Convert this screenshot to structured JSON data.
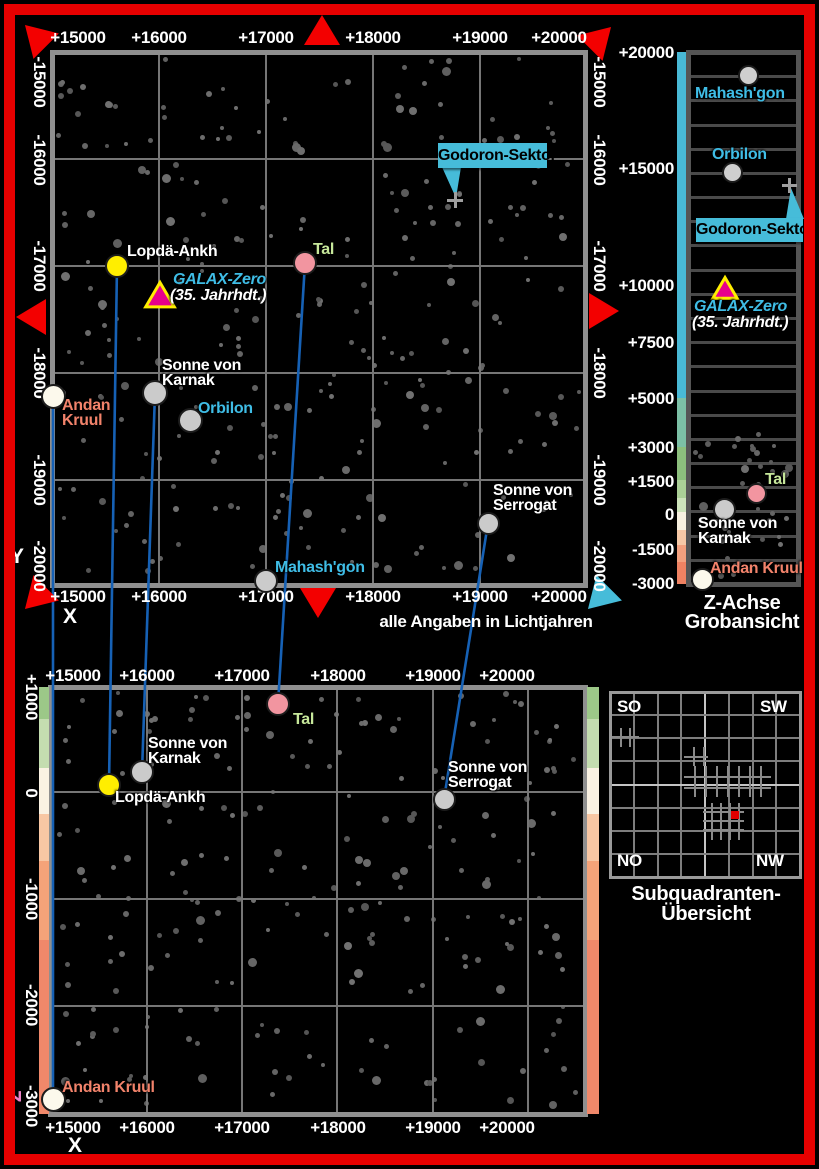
{
  "annotation": "alle Angaben in Lichtjahren",
  "axis_letters": {
    "y": "Y",
    "x_top": "X",
    "x_bottom": "X",
    "z": "Z"
  },
  "colors": {
    "background": "#000000",
    "frame_red": "#e60000",
    "grid": "#767676",
    "map_border": "#8f8f8f",
    "line_blue": "#1661b5",
    "callout_bg": "#46bcd9",
    "cyan_label": "#3fbde6",
    "green_label": "#c6e79a",
    "salmon_label": "#f2836b",
    "z_letter_pink": "#ee82c8",
    "triangle_red": "#f30000",
    "galax_fill": "#e8008c",
    "galax_stroke": "#ffee00",
    "red_square": "#e10000"
  },
  "top_map": {
    "frame": {
      "x": 52,
      "y": 52,
      "w": 533,
      "h": 533
    },
    "grid_v": [
      159,
      266,
      373,
      480
    ],
    "grid_h": [
      159,
      266,
      373,
      480
    ],
    "x_ticks": {
      "labels": [
        "+15000",
        "+16000",
        "+17000",
        "+18000",
        "+19000",
        "+20000"
      ],
      "px": [
        78,
        159,
        266,
        373,
        480,
        559
      ],
      "rows": [
        38,
        597
      ]
    },
    "y_ticks": {
      "labels": [
        "-15000",
        "-16000",
        "-17000",
        "-18000",
        "-19000",
        "-20000"
      ],
      "py": [
        82,
        160,
        266,
        373,
        480,
        566
      ],
      "cols": [
        39,
        599
      ]
    },
    "starfield": {
      "seed": 11,
      "count": 265,
      "area": [
        56,
        56,
        526,
        526
      ]
    },
    "markers": [
      {
        "name": "lopda-ankh",
        "shape": "circle",
        "x": 117,
        "y": 266,
        "d": 20,
        "fill": "#ffee00"
      },
      {
        "name": "tal",
        "shape": "circle",
        "x": 305,
        "y": 263,
        "d": 20,
        "fill": "#f295a0"
      },
      {
        "name": "galax-zero",
        "shape": "triangle",
        "x": 160,
        "y": 296,
        "d": 26,
        "fill": "#e8008c"
      },
      {
        "name": "sonne-von-karnak",
        "shape": "circle",
        "x": 155,
        "y": 393,
        "d": 22,
        "fill": "#cbcbcb"
      },
      {
        "name": "orbilon",
        "shape": "circle",
        "x": 190,
        "y": 420,
        "d": 21,
        "fill": "#cbcbcb"
      },
      {
        "name": "andan-kruul",
        "shape": "circle",
        "x": 53,
        "y": 396,
        "d": 21,
        "fill": "#fcf9ec"
      },
      {
        "name": "mahashgon",
        "shape": "circle",
        "x": 266,
        "y": 581,
        "d": 20,
        "fill": "#cbcbcb"
      },
      {
        "name": "sonne-von-serrogat",
        "shape": "circle",
        "x": 488,
        "y": 523,
        "d": 19,
        "fill": "#cbcbcb"
      },
      {
        "name": "godoron-cross",
        "shape": "cross",
        "x": 455,
        "y": 200,
        "d": 16
      }
    ],
    "labels": [
      {
        "name": "lopda-ankh",
        "lines": [
          "Lopdä-Ankh"
        ],
        "x": 127,
        "y": 244,
        "color": "#ffffff"
      },
      {
        "name": "tal",
        "lines": [
          "Tal"
        ],
        "x": 313,
        "y": 242,
        "color": "#c6e79a"
      },
      {
        "name": "galax-zero",
        "lines": [
          "GALAX-Zero"
        ],
        "x": 173,
        "y": 272,
        "color": "#3fbde6",
        "italic": true
      },
      {
        "name": "galax-zero-era",
        "lines": [
          "(35. Jahrhdt.)"
        ],
        "x": 170,
        "y": 288,
        "color": "#ffffff",
        "italic": true
      },
      {
        "name": "sonne-von-karnak",
        "lines": [
          "Sonne von",
          "Karnak"
        ],
        "x": 162,
        "y": 358,
        "color": "#ffffff"
      },
      {
        "name": "orbilon",
        "lines": [
          "Orbilon"
        ],
        "x": 198,
        "y": 401,
        "color": "#3fbde6"
      },
      {
        "name": "andan-kruul",
        "lines": [
          "Andan",
          "Kruul"
        ],
        "x": 62,
        "y": 398,
        "color": "#f2836b"
      },
      {
        "name": "mahashgon",
        "lines": [
          "Mahash'gon"
        ],
        "x": 275,
        "y": 560,
        "color": "#3fbde6"
      },
      {
        "name": "sonne-von-serrogat",
        "lines": [
          "Sonne von",
          "Serrogat"
        ],
        "x": 493,
        "y": 483,
        "color": "#ffffff"
      }
    ],
    "callout": {
      "text": "Godoron-Sektor",
      "x": 438,
      "y": 143,
      "w": 109,
      "h": 25,
      "tail": [
        [
          442,
          167
        ],
        [
          461,
          167
        ],
        [
          456,
          198
        ]
      ]
    }
  },
  "bottom_map": {
    "frame": {
      "x": 50,
      "y": 687,
      "w": 535,
      "h": 427
    },
    "grid_v": [
      147,
      242,
      337,
      433,
      528
    ],
    "grid_h": [
      792,
      899,
      1006
    ],
    "x_ticks": {
      "labels": [
        "+15000",
        "+16000",
        "+17000",
        "+18000",
        "+19000",
        "+20000"
      ],
      "px": [
        73,
        147,
        242,
        338,
        433,
        507
      ],
      "rows": [
        676,
        1128
      ]
    },
    "z_ticks": {
      "labels": [
        "+1000",
        "0",
        "-1000",
        "-2000",
        "-3000"
      ],
      "py": [
        697,
        793,
        899,
        1005,
        1106
      ],
      "x": 31
    },
    "starfield": {
      "seed": 23,
      "count": 220,
      "area": [
        54,
        691,
        527,
        419
      ]
    },
    "bars": {
      "left_x": 39,
      "left_w": 10,
      "right_x": 587,
      "right_w": 12
    },
    "colorbar_segments": [
      [
        "#9cc888",
        687,
        719
      ],
      [
        "#c4ddb0",
        719,
        768
      ],
      [
        "#faf2e3",
        768,
        814
      ],
      [
        "#f8c7a4",
        814,
        861
      ],
      [
        "#f5a379",
        861,
        940
      ],
      [
        "#f0886a",
        940,
        1114
      ]
    ],
    "markers": [
      {
        "name": "tal",
        "shape": "circle",
        "x": 278,
        "y": 704,
        "d": 20,
        "fill": "#f295a0"
      },
      {
        "name": "sonne-von-karnak",
        "shape": "circle",
        "x": 142,
        "y": 772,
        "d": 20,
        "fill": "#cbcbcb"
      },
      {
        "name": "lopda-ankh",
        "shape": "circle",
        "x": 109,
        "y": 785,
        "d": 20,
        "fill": "#ffee00"
      },
      {
        "name": "sonne-von-serrogat",
        "shape": "circle",
        "x": 444,
        "y": 799,
        "d": 19,
        "fill": "#cbcbcb"
      },
      {
        "name": "andan-kruul",
        "shape": "circle",
        "x": 53,
        "y": 1099,
        "d": 21,
        "fill": "#fcf9ec"
      }
    ],
    "labels": [
      {
        "name": "tal",
        "lines": [
          "Tal"
        ],
        "x": 293,
        "y": 712,
        "color": "#c6e79a"
      },
      {
        "name": "sonne-von-karnak",
        "lines": [
          "Sonne von",
          "Karnak"
        ],
        "x": 148,
        "y": 736,
        "color": "#ffffff"
      },
      {
        "name": "lopda-ankh",
        "lines": [
          "Lopdä-Ankh"
        ],
        "x": 115,
        "y": 790,
        "color": "#ffffff"
      },
      {
        "name": "sonne-von-serrogat",
        "lines": [
          "Sonne von",
          "Serrogat"
        ],
        "x": 448,
        "y": 760,
        "color": "#ffffff"
      },
      {
        "name": "andan-kruul",
        "lines": [
          "Andan Kruul"
        ],
        "x": 62,
        "y": 1080,
        "color": "#f2836b"
      }
    ]
  },
  "zpanel": {
    "frame": {
      "x": 688,
      "y": 52,
      "w": 110,
      "h": 532
    },
    "row_lines": 21,
    "bar": {
      "x": 677,
      "w": 11
    },
    "bar_segments": [
      [
        "#49b9d6",
        52,
        398
      ],
      [
        "#7cc0a6",
        398,
        447
      ],
      [
        "#8cbf7d",
        447,
        480
      ],
      [
        "#abd097",
        480,
        498
      ],
      [
        "#cde3bb",
        498,
        512
      ],
      [
        "#f7f0e0",
        512,
        530
      ],
      [
        "#f6c8a6",
        530,
        545
      ],
      [
        "#f3a07e",
        545,
        562
      ],
      [
        "#ef8262",
        562,
        584
      ]
    ],
    "ticks": {
      "labels": [
        "+20000",
        "+15000",
        "+10000",
        "+7500",
        "+5000",
        "+3000",
        "+1500",
        "0",
        "-1500",
        "-3000"
      ],
      "py": [
        52,
        168,
        285,
        342,
        398,
        447,
        481,
        514,
        549,
        583
      ]
    },
    "starfield": {
      "seed": 5,
      "count": 40,
      "area": [
        692,
        430,
        102,
        150
      ]
    },
    "markers": [
      {
        "name": "mahashgon",
        "shape": "circle",
        "x": 748,
        "y": 75,
        "d": 17,
        "fill": "#cfcfcf"
      },
      {
        "name": "orbilon",
        "shape": "circle",
        "x": 732,
        "y": 172,
        "d": 17,
        "fill": "#cfcfcf"
      },
      {
        "name": "godoron-cross",
        "shape": "cross",
        "x": 789,
        "y": 185,
        "d": 15
      },
      {
        "name": "galax-zero",
        "shape": "triangle",
        "x": 725,
        "y": 289,
        "d": 22,
        "fill": "#e8008c"
      },
      {
        "name": "tal",
        "shape": "circle",
        "x": 756,
        "y": 493,
        "d": 17,
        "fill": "#f295a0"
      },
      {
        "name": "sonne-von-karnak",
        "shape": "circle",
        "x": 724,
        "y": 509,
        "d": 19,
        "fill": "#cbcbcb"
      },
      {
        "name": "andan-kruul",
        "shape": "circle",
        "x": 702,
        "y": 579,
        "d": 19,
        "fill": "#fcf9ec"
      }
    ],
    "labels": [
      {
        "name": "mahashgon",
        "lines": [
          "Mahash'gon"
        ],
        "x": 695,
        "y": 86,
        "color": "#3fbde6"
      },
      {
        "name": "orbilon",
        "lines": [
          "Orbilon"
        ],
        "x": 712,
        "y": 147,
        "color": "#3fbde6"
      },
      {
        "name": "galax-zero",
        "lines": [
          "GALAX-Zero"
        ],
        "x": 694,
        "y": 299,
        "color": "#3fbde6",
        "italic": true
      },
      {
        "name": "galax-zero-era",
        "lines": [
          "(35. Jahrhdt.)"
        ],
        "x": 692,
        "y": 315,
        "color": "#ffffff",
        "italic": true
      },
      {
        "name": "tal",
        "lines": [
          "Tal"
        ],
        "x": 765,
        "y": 472,
        "color": "#c6e79a"
      },
      {
        "name": "sonne-von-karnak",
        "lines": [
          "Sonne von",
          "Karnak"
        ],
        "x": 698,
        "y": 516,
        "color": "#ffffff"
      },
      {
        "name": "andan-kruul",
        "lines": [
          "Andan Kruul"
        ],
        "x": 710,
        "y": 561,
        "color": "#f2836b"
      }
    ],
    "callout": {
      "text": "Godoron-Sektor",
      "x": 696,
      "y": 218,
      "w": 107,
      "h": 24,
      "tail": [
        [
          786,
          219
        ],
        [
          804,
          219
        ],
        [
          791,
          188
        ]
      ]
    },
    "title": {
      "lines": [
        "Z-Achse",
        "Grobansicht"
      ]
    }
  },
  "subquadrant": {
    "frame": {
      "x": 610,
      "y": 692,
      "w": 190,
      "h": 185
    },
    "cols": 8,
    "rows": 8,
    "corners": [
      {
        "text": "SO"
      },
      {
        "text": "SW"
      },
      {
        "text": "NO"
      },
      {
        "text": "NW"
      }
    ],
    "fine_regions": [
      [
        612,
        728,
        27,
        19,
        9
      ],
      [
        684,
        747,
        24,
        19,
        10
      ],
      [
        684,
        766,
        87,
        31,
        11
      ],
      [
        703,
        803,
        41,
        37,
        9
      ]
    ],
    "red_square": [
      731,
      811,
      8
    ],
    "title": {
      "lines": [
        "Subquadranten-",
        "Übersicht"
      ]
    }
  },
  "connectors": [
    {
      "name": "andan-kruul",
      "from": [
        53,
        396
      ],
      "to": [
        53,
        1099
      ]
    },
    {
      "name": "lopda-ankh",
      "from": [
        117,
        266
      ],
      "to": [
        109,
        785
      ]
    },
    {
      "name": "sonne-von-karnak",
      "from": [
        155,
        393
      ],
      "to": [
        142,
        772
      ]
    },
    {
      "name": "tal",
      "from": [
        305,
        263
      ],
      "to": [
        278,
        704
      ]
    },
    {
      "name": "sonne-von-serrogat",
      "from": [
        488,
        523
      ],
      "to": [
        444,
        799
      ]
    }
  ],
  "triangles": [
    {
      "x": 37,
      "y": 37,
      "angle": -45,
      "color": "#f30000"
    },
    {
      "x": 322,
      "y": 32,
      "angle": 0,
      "color": "#f30000"
    },
    {
      "x": 599,
      "y": 39,
      "angle": 45,
      "color": "#f30000"
    },
    {
      "x": 33,
      "y": 317,
      "angle": -90,
      "color": "#f30000"
    },
    {
      "x": 602,
      "y": 311,
      "angle": 90,
      "color": "#f30000"
    },
    {
      "x": 37,
      "y": 597,
      "angle": -135,
      "color": "#f30000"
    },
    {
      "x": 318,
      "y": 601,
      "angle": 180,
      "color": "#f30000"
    },
    {
      "x": 600,
      "y": 597,
      "angle": -135,
      "color": "#46bcd9"
    }
  ]
}
